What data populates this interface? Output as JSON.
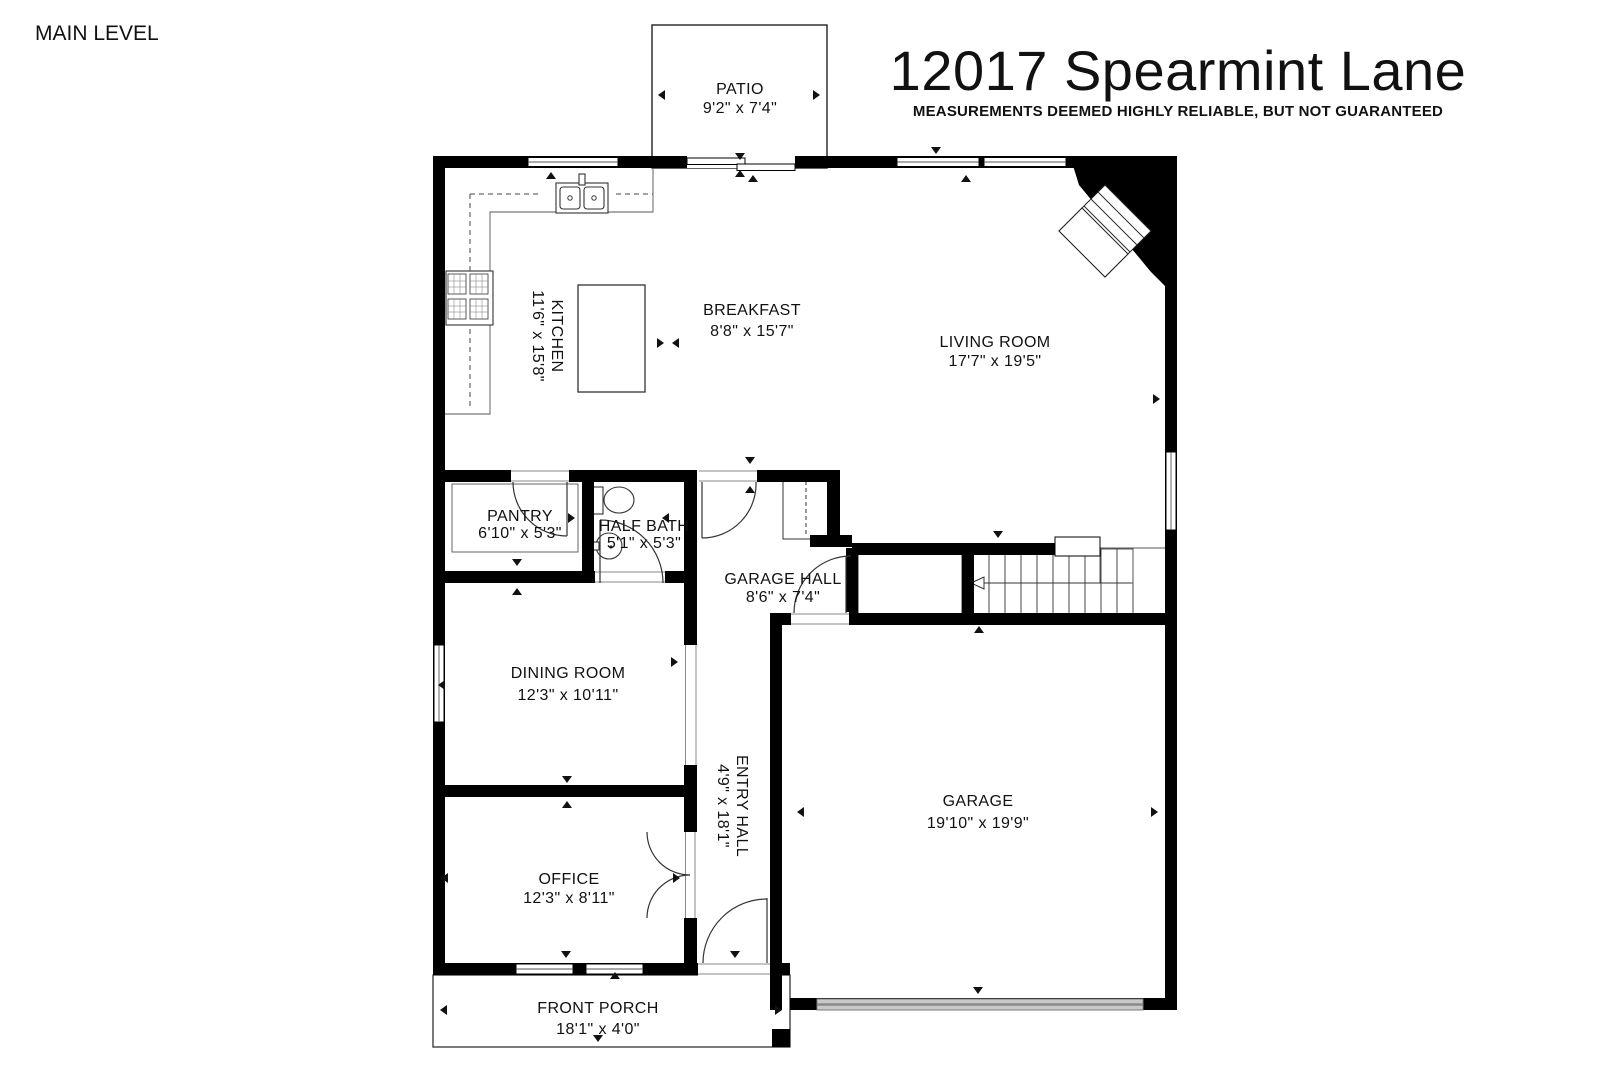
{
  "header": {
    "level_label": "MAIN LEVEL",
    "title": "12017 Spearmint Lane",
    "disclaimer": "MEASUREMENTS DEEMED HIGHLY RELIABLE, BUT NOT GUARANTEED"
  },
  "rooms": {
    "patio": {
      "name": "PATIO",
      "dims": "9'2\" x 7'4\""
    },
    "kitchen": {
      "name": "KITCHEN",
      "dims": "11'6\" x 15'8\""
    },
    "breakfast": {
      "name": "BREAKFAST",
      "dims": "8'8\" x 15'7\""
    },
    "living": {
      "name": "LIVING ROOM",
      "dims": "17'7\" x 19'5\""
    },
    "pantry": {
      "name": "PANTRY",
      "dims": "6'10\" x 5'3\""
    },
    "half_bath": {
      "name": "HALF BATH",
      "dims": "5'1\" x 5'3\""
    },
    "garage_hall": {
      "name": "GARAGE HALL",
      "dims": "8'6\" x 7'4\""
    },
    "dining": {
      "name": "DINING ROOM",
      "dims": "12'3\" x 10'11\""
    },
    "entry_hall": {
      "name": "ENTRY HALL",
      "dims": "4'9\" x 18'1\""
    },
    "office": {
      "name": "OFFICE",
      "dims": "12'3\" x 8'11\""
    },
    "garage": {
      "name": "GARAGE",
      "dims": "19'10\" x 19'9\""
    },
    "front_porch": {
      "name": "FRONT PORCH",
      "dims": "18'1\" x 4'0\""
    }
  },
  "colors": {
    "wall": "#000000",
    "text": "#111111",
    "garage_door": "#c9c9c9"
  }
}
